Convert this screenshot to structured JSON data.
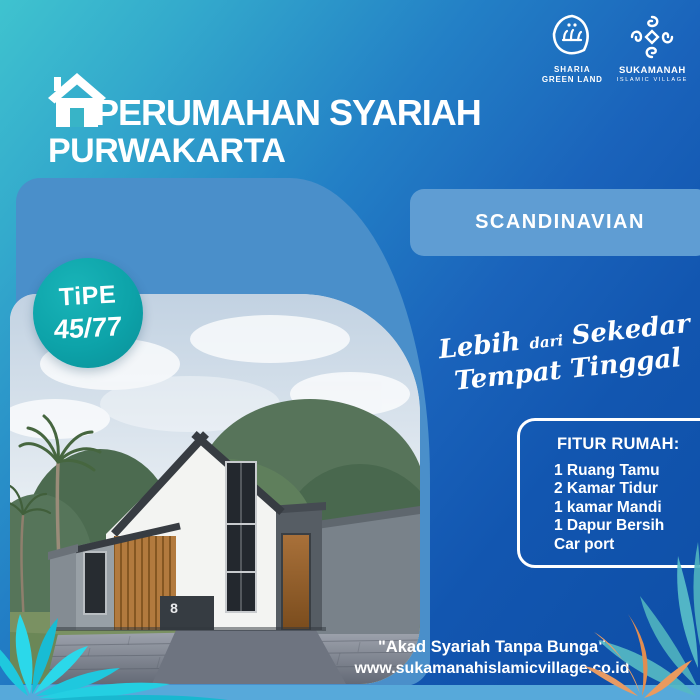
{
  "header": {
    "title_line1": "PERUMAHAN SYARIAH",
    "title_line2": "PURWAKARTA"
  },
  "logos": {
    "sharia_green_land": {
      "name_line1": "SHARIA",
      "name_line2": "GREEN LAND"
    },
    "sukamanah": {
      "name_line1": "SUKAMANAH",
      "name_line2": "ISLAMIC VILLAGE"
    }
  },
  "style_banner": {
    "label": "SCANDINAVIAN"
  },
  "type_badge": {
    "line1": "TiPE",
    "line2": "45/77"
  },
  "tagline": {
    "word1": "Lebih",
    "word2": "dari",
    "word3": "Sekedar",
    "line2": "Tempat Tinggal"
  },
  "features": {
    "title": "FITUR RUMAH:",
    "items": [
      "1 Ruang Tamu",
      "2 Kamar Tidur",
      "1 kamar Mandi",
      "1 Dapur Bersih",
      "Car port"
    ]
  },
  "footer": {
    "slogan": "\"Akad Syariah Tanpa Bunga\"",
    "website": "www.sukamanahislamicvillage.co.id"
  },
  "photo": {
    "house_number": "8"
  },
  "colors": {
    "background_teal": "#3fc3cf",
    "background_blue": "#0e4ea6",
    "panel_blue": "#4a8fca",
    "banner_blue": "#5f9dd3",
    "badge_teal": "#0da3a9",
    "bottom_bar_blue": "#57a9da",
    "leaf_cyan": "#24cfe2",
    "leaf_teal": "#55b9c4",
    "leaf_orange": "#e79a63",
    "text_white": "#ffffff"
  }
}
